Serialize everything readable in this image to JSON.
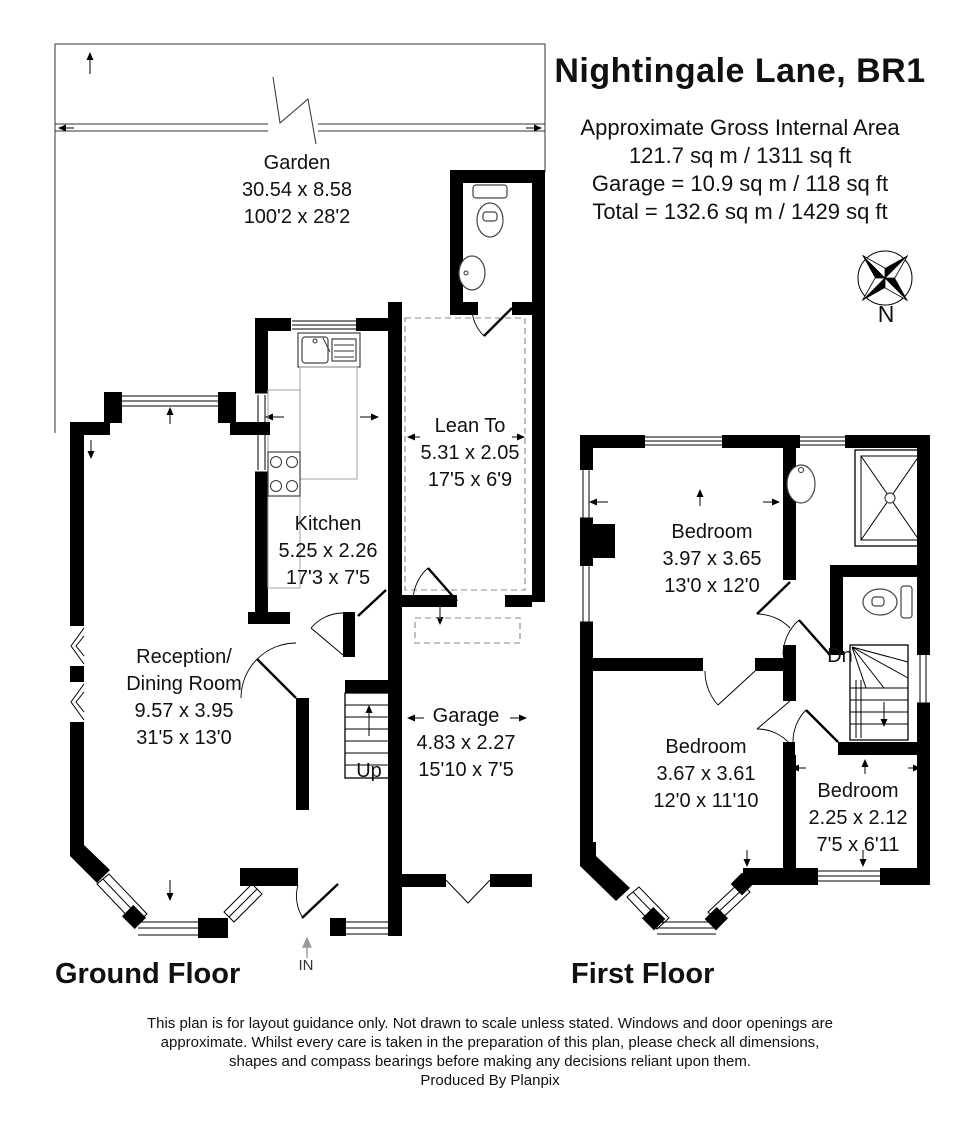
{
  "header": {
    "title": "Nightingale Lane, BR1",
    "area_summary": {
      "line1": "Approximate Gross Internal Area",
      "line2": "121.7 sq m / 1311 sq ft",
      "line3": "Garage = 10.9 sq m / 118 sq ft",
      "line4": "Total = 132.6 sq m / 1429 sq ft"
    }
  },
  "compass": {
    "north_label": "N"
  },
  "floors": {
    "ground": {
      "label": "Ground Floor",
      "stairs_label": "Up",
      "entrance_label": "IN",
      "rooms": {
        "garden": {
          "name": "Garden",
          "metric": "30.54 x 8.58",
          "imperial": "100'2 x 28'2"
        },
        "lean_to": {
          "name": "Lean To",
          "metric": "5.31 x 2.05",
          "imperial": "17'5 x 6'9"
        },
        "kitchen": {
          "name": "Kitchen",
          "metric": "5.25 x 2.26",
          "imperial": "17'3 x 7'5"
        },
        "reception": {
          "name_line1": "Reception/",
          "name_line2": "Dining Room",
          "metric": "9.57 x 3.95",
          "imperial": "31'5 x 13'0"
        },
        "garage": {
          "name": "Garage",
          "metric": "4.83 x 2.27",
          "imperial": "15'10 x 7'5"
        }
      }
    },
    "first": {
      "label": "First Floor",
      "stairs_label": "Dn",
      "rooms": {
        "bedroom1": {
          "name": "Bedroom",
          "metric": "3.97 x 3.65",
          "imperial": "13'0 x 12'0"
        },
        "bedroom2": {
          "name": "Bedroom",
          "metric": "3.67 x 3.61",
          "imperial": "12'0 x 11'10"
        },
        "bedroom3": {
          "name": "Bedroom",
          "metric": "2.25 x 2.12",
          "imperial": "7'5 x 6'11"
        }
      }
    }
  },
  "footer": {
    "disclaimer": "This plan is for layout guidance only. Not drawn to scale unless stated. Windows and door openings are approximate. Whilst every care is taken in the preparation of this plan, please check all dimensions, shapes and compass bearings before making any decisions reliant upon them.",
    "credit": "Produced By Planpix"
  }
}
